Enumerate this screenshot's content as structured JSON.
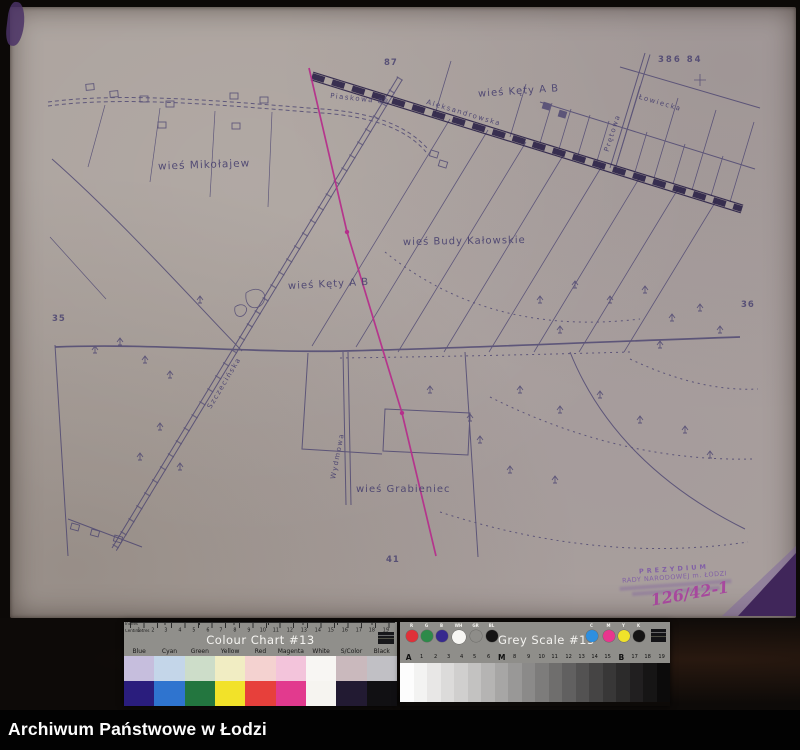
{
  "archive_bar": {
    "title": "Archiwum Państwowe w Łodzi"
  },
  "map": {
    "villages": [
      {
        "label": "wieś Mikołajew"
      },
      {
        "label": "wieś Kęty A B"
      },
      {
        "label": "wieś Budy Kałowskie"
      },
      {
        "label": "wieś Kęty A B"
      },
      {
        "label": "wieś Grabieniec"
      }
    ],
    "streets": [
      {
        "label": "Aleksandrowska"
      },
      {
        "label": "Szczecińska"
      },
      {
        "label": "Wydmowa"
      },
      {
        "label": "Łowiecka"
      },
      {
        "label": "Prętowa"
      },
      {
        "label": "Piaskowa 88"
      }
    ],
    "sheet_marks": {
      "top": "87",
      "top_right": "386 84",
      "left": "35",
      "right": "36",
      "bottom": "41"
    },
    "stamp": {
      "line1": "PREZYDIUM",
      "line2": "RADY NARODOWEJ m. ŁODZI",
      "handwritten": "126/42-1"
    },
    "colors": {
      "paper": "#aba29d",
      "ink": "#453e6e",
      "railway_ink": "#2c2348",
      "survey_line": "#b52f8b",
      "stamp_ink": "#7b55a8",
      "corner_patch": "#40265a"
    }
  },
  "colour_chart": {
    "title": "Colour Chart #13",
    "inches_label": "Inches",
    "centimetres_label": "Centimetres",
    "cm_numbers": [
      "1",
      "2",
      "3",
      "4",
      "5",
      "6",
      "7",
      "8",
      "9",
      "10",
      "11",
      "12",
      "13",
      "14",
      "15",
      "16",
      "17",
      "18",
      "19"
    ],
    "columns": [
      {
        "name": "Blue",
        "pale": "#c6bedd",
        "saturated": "#2a1d7d"
      },
      {
        "name": "Cyan",
        "pale": "#c4d6e9",
        "saturated": "#2f74cf"
      },
      {
        "name": "Green",
        "pale": "#cdddc9",
        "saturated": "#23763f"
      },
      {
        "name": "Yellow",
        "pale": "#f1edc3",
        "saturated": "#f2e229"
      },
      {
        "name": "Red",
        "pale": "#f4d2d0",
        "saturated": "#e7403b"
      },
      {
        "name": "Magenta",
        "pale": "#f3c4db",
        "saturated": "#e23a8e"
      },
      {
        "name": "White",
        "pale": "#f8f6f3",
        "saturated": "#f6f4f0"
      },
      {
        "name": "S/Color",
        "pale": "#cab9bd",
        "saturated": "#221a32"
      },
      {
        "name": "Black",
        "pale": "#c1c0c5",
        "saturated": "#111013"
      }
    ]
  },
  "grey_scale": {
    "title": "Grey Scale #13",
    "circles": [
      {
        "label": "R",
        "color": "#e03038"
      },
      {
        "label": "G",
        "color": "#2d8a49"
      },
      {
        "label": "B",
        "color": "#37298e"
      },
      {
        "label": "WH",
        "color": "#f7f6f3"
      },
      {
        "label": "GR",
        "color": "#8e8d89"
      },
      {
        "label": "BL",
        "color": "#141313"
      },
      {
        "label": "C",
        "color": "#2e8fdf"
      },
      {
        "label": "M",
        "color": "#e8368e"
      },
      {
        "label": "Y",
        "color": "#f0e22a"
      },
      {
        "label": "K",
        "color": "#151414"
      }
    ],
    "index_labels": [
      "A",
      "1",
      "2",
      "3",
      "4",
      "5",
      "6",
      "M",
      "8",
      "9",
      "10",
      "11",
      "12",
      "13",
      "14",
      "15",
      "B",
      "17",
      "18",
      "19"
    ],
    "step_greys": [
      "#fdfdfd",
      "#f3f3f2",
      "#e8e7e6",
      "#dcdbda",
      "#d0cfce",
      "#c3c2c1",
      "#b5b4b3",
      "#a7a6a5",
      "#999897",
      "#8b8a89",
      "#7d7c7b",
      "#6f6e6d",
      "#616060",
      "#535252",
      "#454444",
      "#383737",
      "#2c2b2b",
      "#211f20",
      "#161515",
      "#0c0b0b"
    ]
  }
}
